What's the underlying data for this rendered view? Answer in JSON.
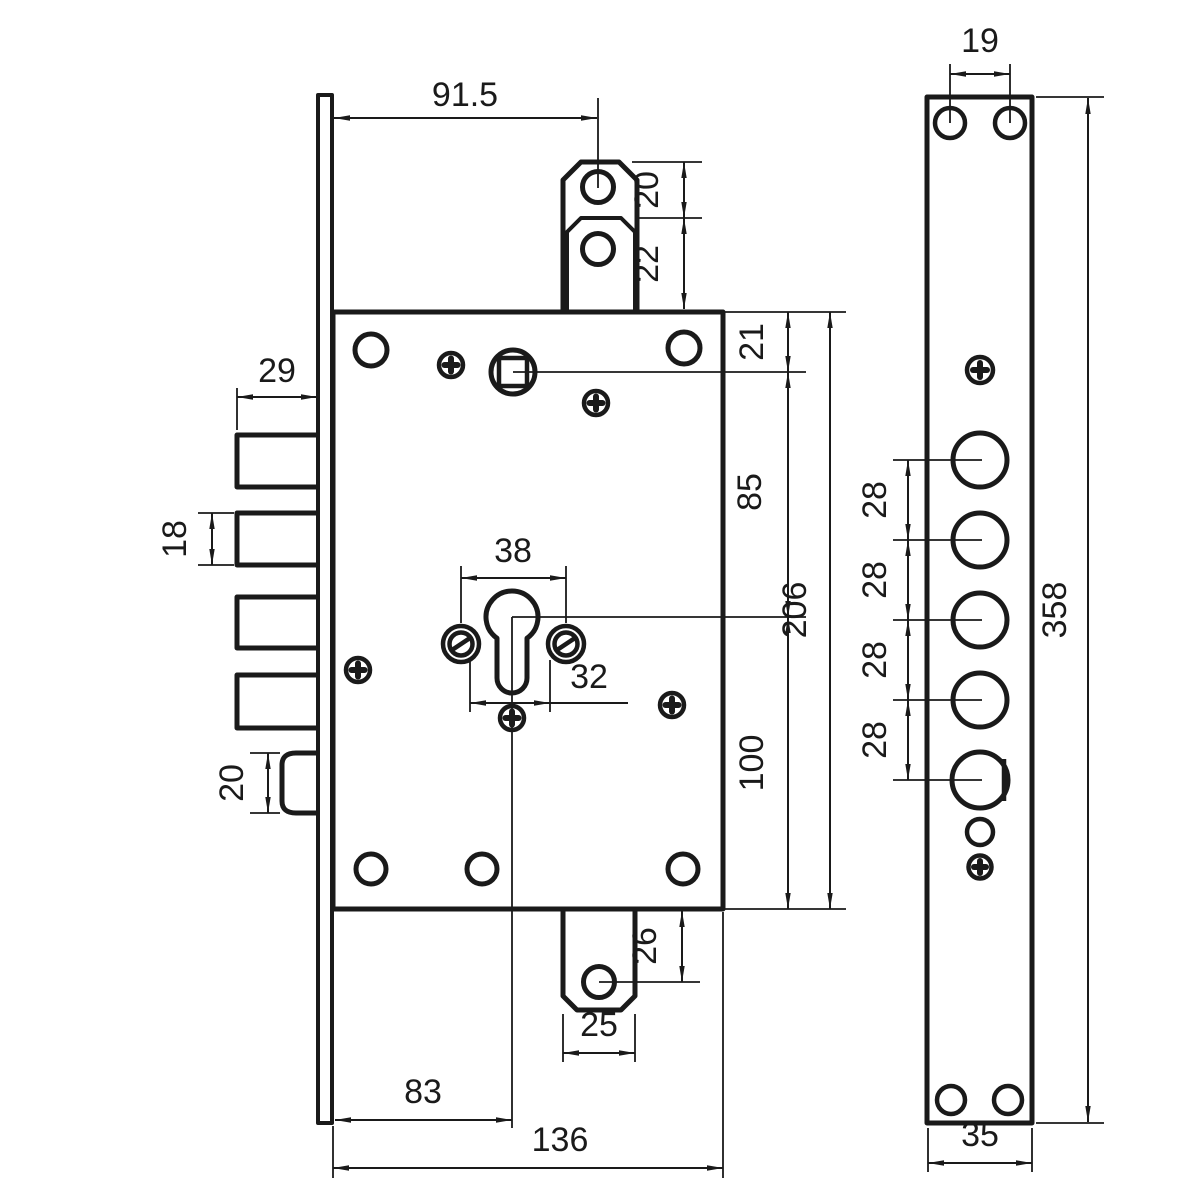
{
  "drawing": {
    "background_color": "#ffffff",
    "line_color": "#1a1a1a",
    "front_view": {
      "dim_faceplate_to_tab_axis": "91.5",
      "dim_tab_hole_upper": "20",
      "dim_tab_hole_lower": "22",
      "dim_top_edge_to_spindle": "21",
      "dim_deadbolt_throw": "29",
      "dim_spindle_to_cylinder": "85",
      "dim_case_height": "206",
      "dim_deadbolt_height": "18",
      "dim_cylinder_screw_spacing": "38",
      "dim_cylinder_lower_spacing": "32",
      "dim_cylinder_to_bottom_edge": "100",
      "dim_latch_height": "20",
      "dim_bottom_tab_hole_offset": "26",
      "dim_bottom_tab_width": "25",
      "dim_faceplate_to_cylinder_axis": "83",
      "dim_case_width": "136"
    },
    "side_view": {
      "dim_screw_hole_spacing": "19",
      "dim_bore_spacing": [
        "28",
        "28",
        "28",
        "28"
      ],
      "dim_faceplate_length": "358",
      "dim_faceplate_width": "35"
    }
  }
}
